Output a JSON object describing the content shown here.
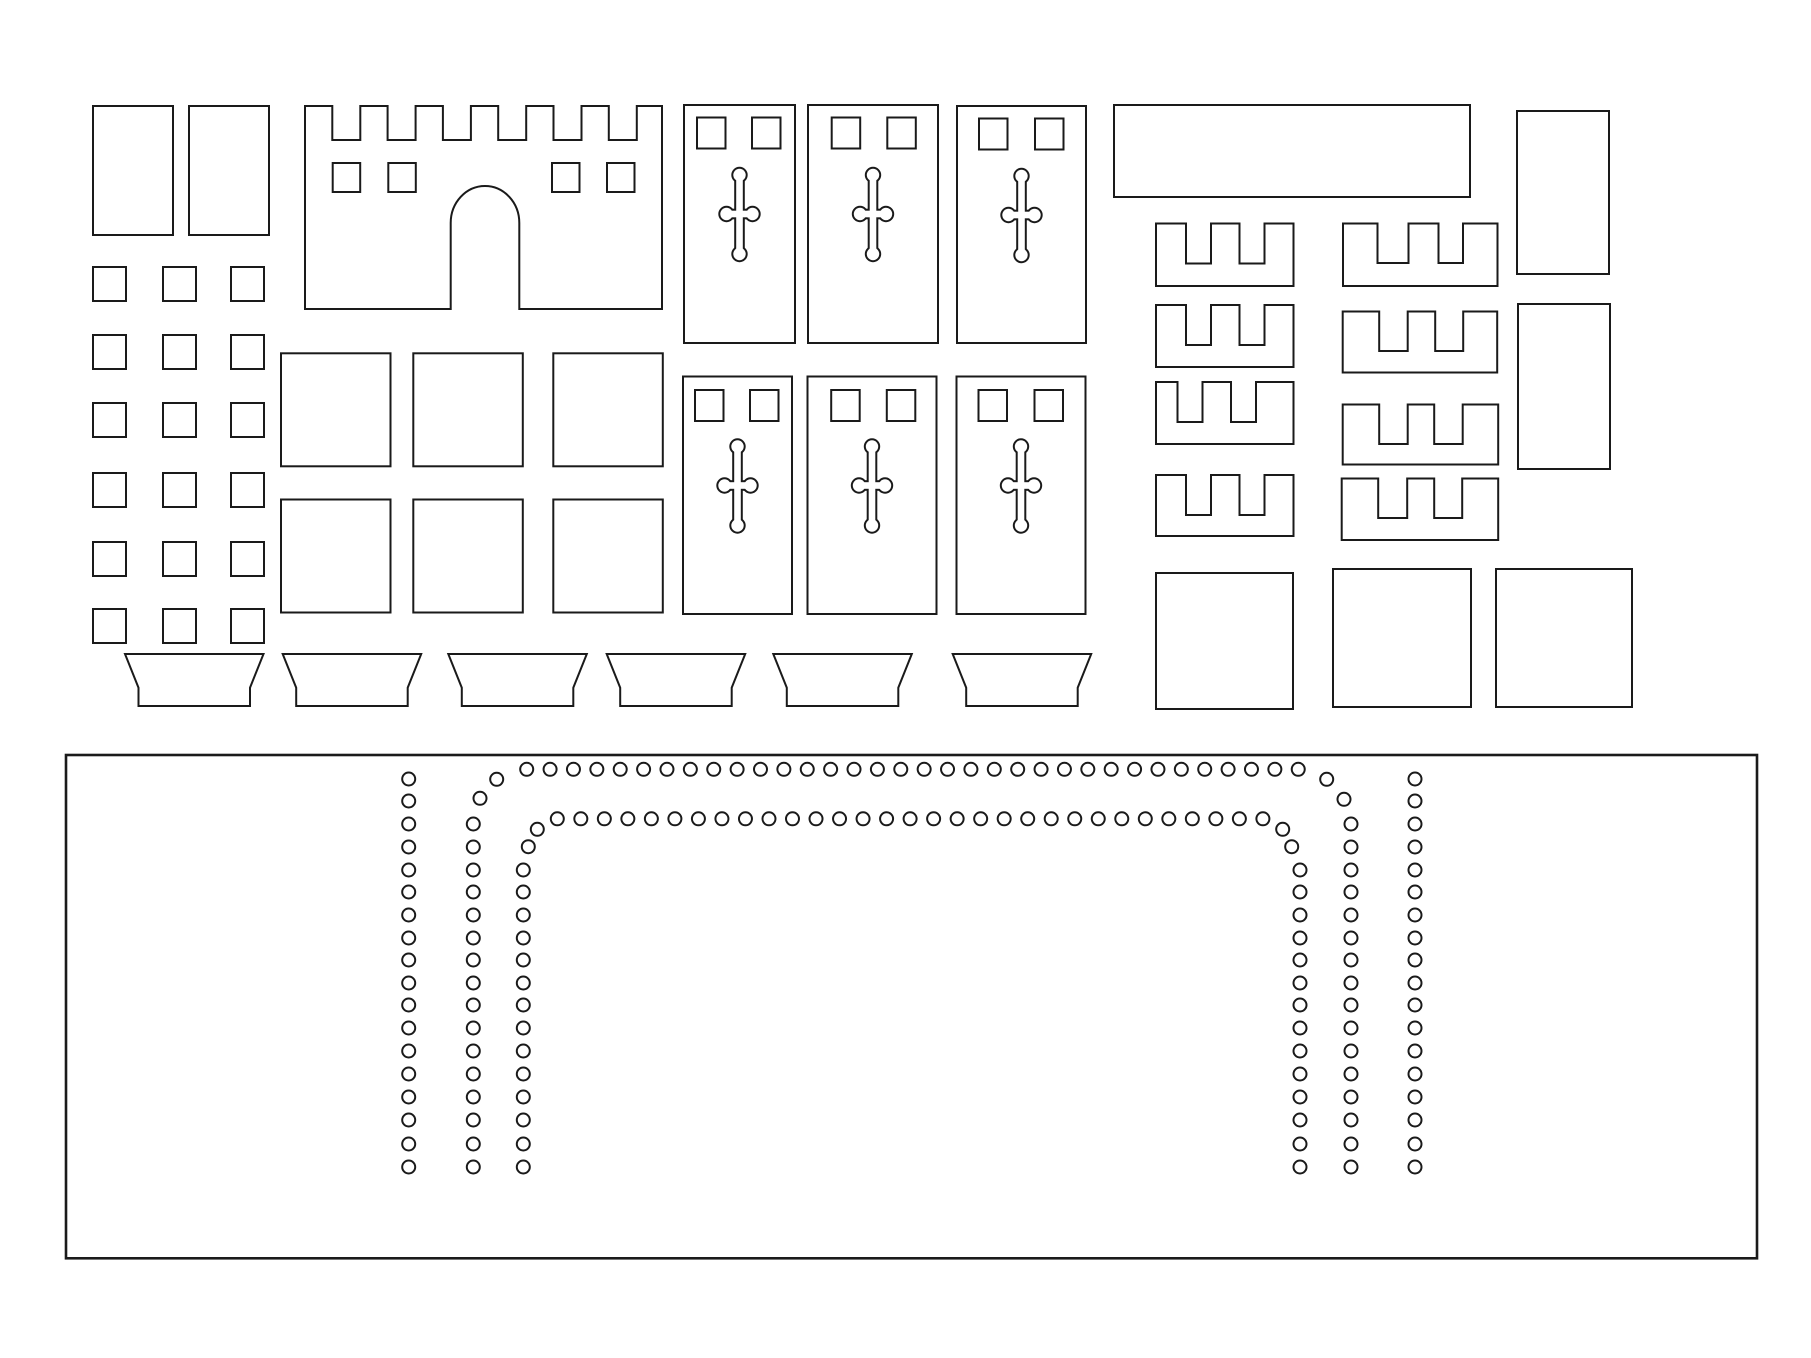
{
  "document": {
    "title": "castle-craft-cutting-template",
    "canvas_width": 1811,
    "canvas_height": 1358,
    "background_color": "#ffffff",
    "line_color": "#1a1a1a",
    "line_width": 2,
    "panel_line_width": 2.6
  },
  "plain_rects": [
    {
      "name": "tall-rect-1",
      "x": 93,
      "y": 106,
      "w": 80,
      "h": 129
    },
    {
      "name": "tall-rect-2",
      "x": 189,
      "y": 106,
      "w": 80,
      "h": 129
    },
    {
      "name": "long-rect",
      "x": 1114,
      "y": 105,
      "w": 356,
      "h": 92
    },
    {
      "name": "side-rect-1",
      "x": 1517,
      "y": 111,
      "w": 92,
      "h": 163
    },
    {
      "name": "side-rect-2",
      "x": 1518,
      "y": 304,
      "w": 92,
      "h": 165
    },
    {
      "name": "corner-square-1",
      "x": 1156,
      "y": 573,
      "w": 137,
      "h": 136
    },
    {
      "name": "corner-square-2",
      "x": 1333,
      "y": 569,
      "w": 138,
      "h": 138
    },
    {
      "name": "corner-square-3",
      "x": 1496,
      "y": 569,
      "w": 136,
      "h": 138
    }
  ],
  "small_square_grid": {
    "cols_x": [
      93,
      163,
      231
    ],
    "rows_y": [
      267,
      335,
      403,
      473,
      542,
      609
    ],
    "w": 33,
    "h": 34
  },
  "mid_square_grid": {
    "cols_x": [
      281,
      413.3,
      553.3
    ],
    "rows_y": [
      353.3,
      499.5
    ],
    "w": 109.5,
    "h": 113
  },
  "castle": {
    "x": 305,
    "right": 662,
    "top": 106,
    "bottom": 309,
    "notch_starts": [
      332.3,
      387.6,
      442.9,
      498.2,
      553.5,
      608.8
    ],
    "notch_w": 28,
    "notch_depth": 34,
    "windows_x": [
      332.7,
      388.3,
      552,
      607
    ],
    "window_y": 163,
    "window_w": 27.5,
    "window_h": 29,
    "arch": {
      "cx": 485,
      "rx": 34.3,
      "ry": 37,
      "spring_y": 223
    }
  },
  "banners": [
    {
      "x": 684,
      "y": 105,
      "w": 111,
      "h": 238,
      "win_dx": [
        13,
        68
      ],
      "win_y": 12.5
    },
    {
      "x": 808,
      "y": 105,
      "w": 130,
      "h": 238,
      "win_dx": [
        23.7,
        79.3
      ],
      "win_y": 12.5
    },
    {
      "x": 957,
      "y": 106,
      "w": 129,
      "h": 237,
      "win_dx": [
        22,
        78
      ],
      "win_y": 12.5
    },
    {
      "x": 683,
      "y": 376.5,
      "w": 109,
      "h": 237.5,
      "win_dx": [
        12,
        67
      ],
      "win_y": 13.5
    },
    {
      "x": 807.5,
      "y": 376.5,
      "w": 129,
      "h": 237.5,
      "win_dx": [
        23.7,
        79.3
      ],
      "win_y": 13.5
    },
    {
      "x": 956.5,
      "y": 376.5,
      "w": 129,
      "h": 237.5,
      "win_dx": [
        22,
        78
      ],
      "win_y": 13.5
    }
  ],
  "banner_style": {
    "window_w": 28.5,
    "window_h": 31,
    "cross": {
      "top": 70,
      "bottom": 149,
      "bar": 109,
      "arm": 13,
      "stem_w": 6.6,
      "knob_r": 6.2
    }
  },
  "combs": [
    {
      "x": 1156,
      "y": 223.5,
      "w": 137.5,
      "h": 62.5,
      "depth": 40,
      "notches": [
        [
          30,
          55
        ],
        [
          83.5,
          108.5
        ]
      ]
    },
    {
      "x": 1156,
      "y": 305,
      "w": 137.5,
      "h": 62,
      "depth": 40,
      "notches": [
        [
          30,
          55
        ],
        [
          83.5,
          108.5
        ]
      ]
    },
    {
      "x": 1156,
      "y": 382,
      "w": 137.5,
      "h": 62,
      "depth": 40,
      "notches": [
        [
          21.5,
          46.5
        ],
        [
          75,
          100
        ]
      ]
    },
    {
      "x": 1156,
      "y": 475,
      "w": 137.5,
      "h": 61,
      "depth": 40,
      "notches": [
        [
          30,
          55
        ],
        [
          83.5,
          108.5
        ]
      ]
    },
    {
      "x": 1343,
      "y": 223.5,
      "w": 154.5,
      "h": 62.5,
      "depth": 39.5,
      "notches": [
        [
          34.5,
          65.5
        ],
        [
          95.5,
          120
        ]
      ]
    },
    {
      "x": 1342.7,
      "y": 311.5,
      "w": 154.5,
      "h": 61,
      "depth": 39.5,
      "notches": [
        [
          36.5,
          65
        ],
        [
          92.5,
          120.5
        ]
      ]
    },
    {
      "x": 1342.7,
      "y": 404.5,
      "w": 155.5,
      "h": 60,
      "depth": 39.5,
      "notches": [
        [
          36.5,
          65
        ],
        [
          91.5,
          120
        ]
      ]
    },
    {
      "x": 1341.7,
      "y": 478.5,
      "w": 156.5,
      "h": 61.5,
      "depth": 39.5,
      "notches": [
        [
          36.5,
          65.5
        ],
        [
          92.5,
          120.5
        ]
      ]
    }
  ],
  "trapezoids": {
    "x_list": [
      125,
      282.7,
      448.3,
      606.7,
      773.3,
      952.7
    ],
    "top_y": 654,
    "bottom_y": 706,
    "top_w": 138.5,
    "inset": 13.5,
    "knee_y": 687.7
  },
  "base_panel": {
    "x": 66,
    "y": 755,
    "w": 1691,
    "h": 503.3,
    "hole_r": 6.5,
    "col_ys": [
      779,
      801,
      824,
      847,
      870,
      892,
      915,
      938,
      960,
      983,
      1005,
      1028,
      1051,
      1074,
      1097,
      1120,
      1144,
      1167
    ],
    "columns": [
      {
        "x": 408.7,
        "from": 0
      },
      {
        "x": 473.3,
        "from": 2
      },
      {
        "x": 523.3,
        "from": 4
      },
      {
        "x": 1300,
        "from": 4
      },
      {
        "x": 1351,
        "from": 2
      },
      {
        "x": 1415,
        "from": 0
      }
    ],
    "rows": [
      {
        "y": 769.3,
        "x0": 526.7,
        "count": 34,
        "step": 23.38
      },
      {
        "y": 818.8,
        "x0": 557.3,
        "count": 31,
        "step": 23.52
      }
    ],
    "extra_holes": [
      [
        496.7,
        779.3
      ],
      [
        480,
        798.3
      ],
      [
        537.3,
        829.3
      ],
      [
        528.3,
        846.7
      ],
      [
        1326.7,
        779.3
      ],
      [
        1344,
        799.3
      ],
      [
        1282.7,
        829.3
      ],
      [
        1291.7,
        846.7
      ]
    ]
  }
}
